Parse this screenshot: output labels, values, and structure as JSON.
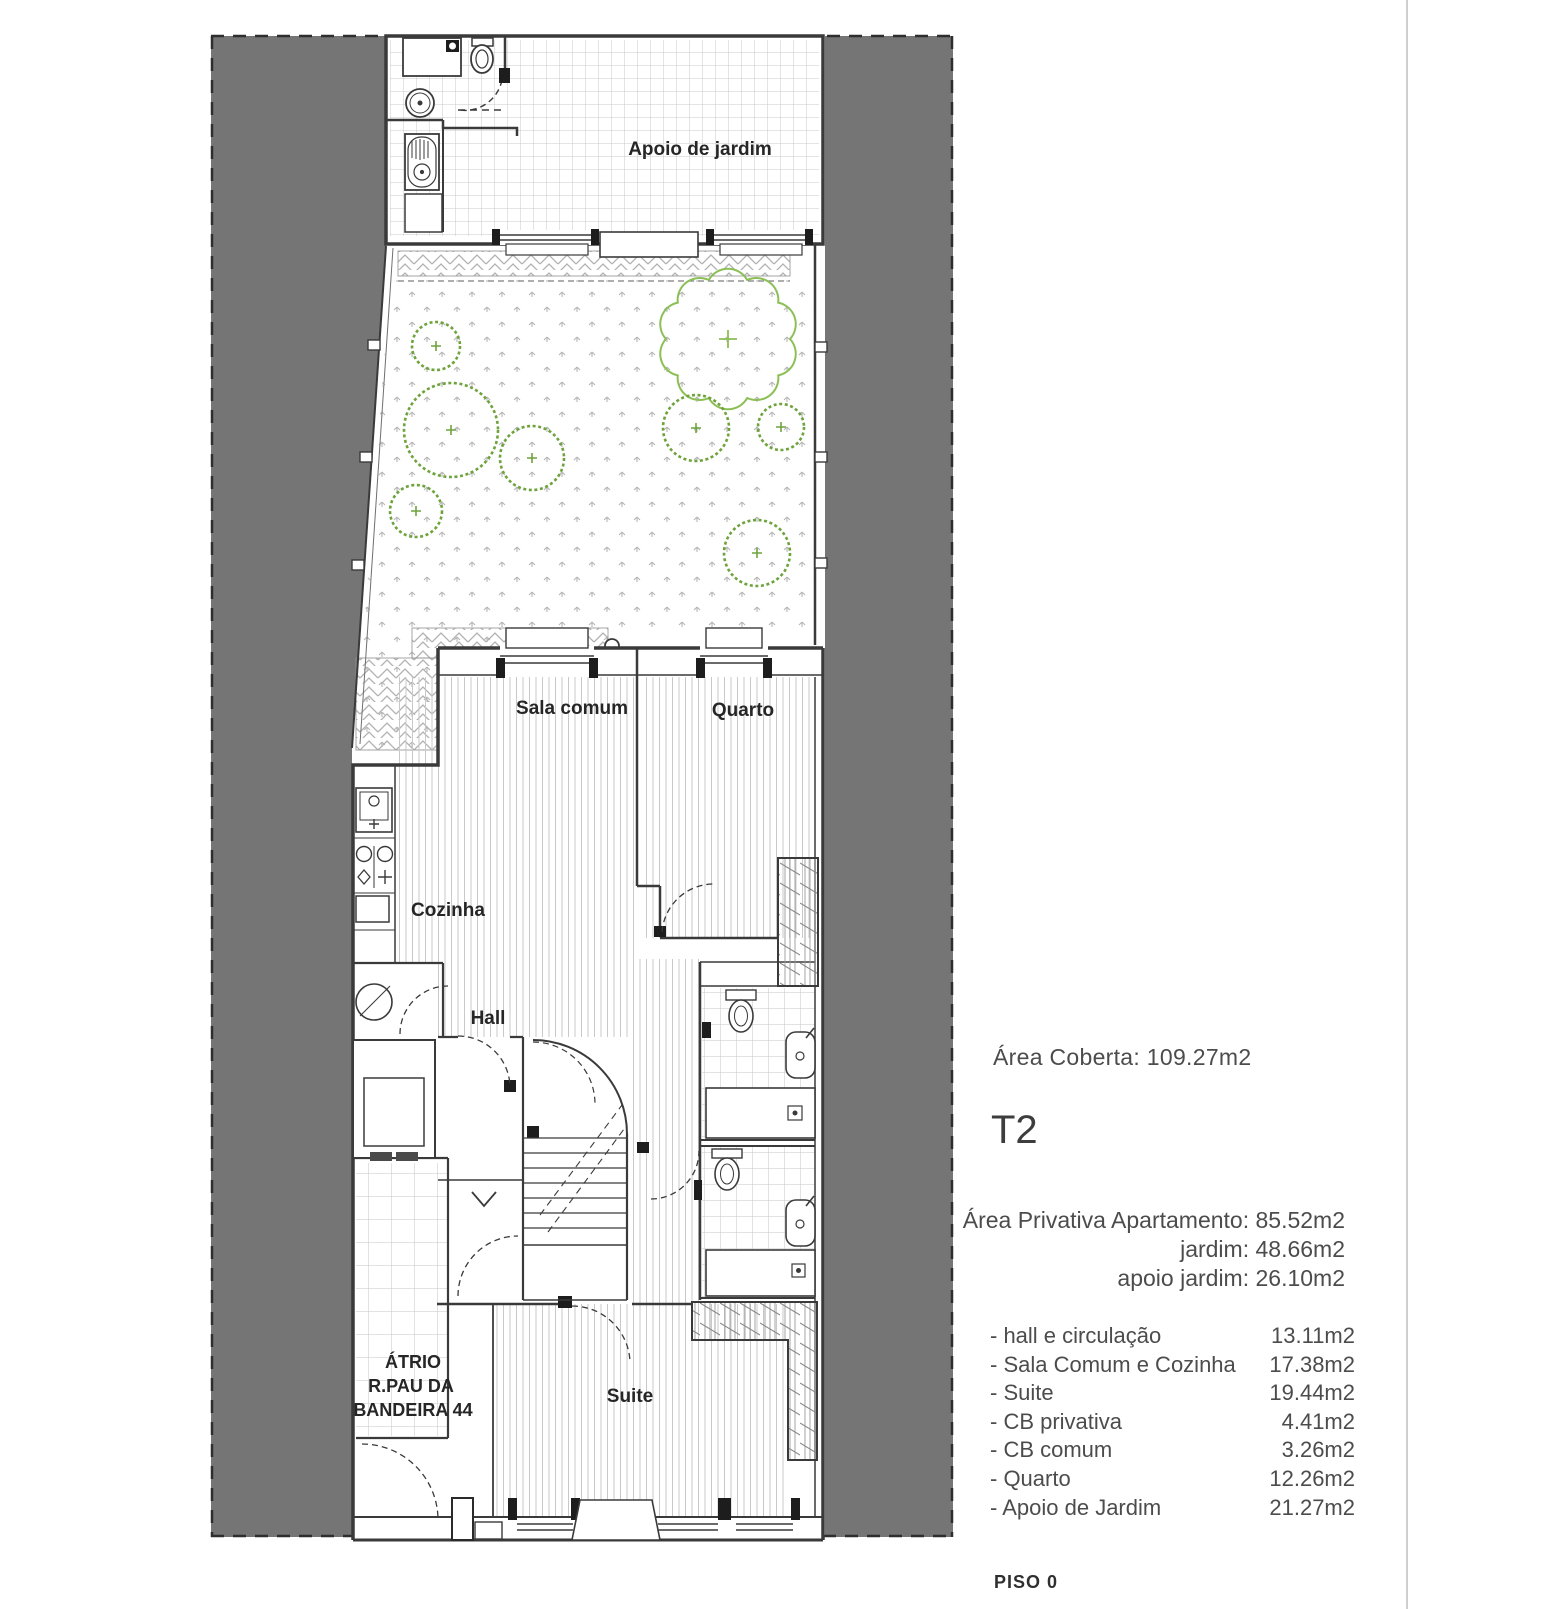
{
  "plan": {
    "labels": {
      "apoio": "Apoio de jardim",
      "sala": "Sala comum",
      "quarto": "Quarto",
      "cozinha": "Cozinha",
      "hall": "Hall",
      "suite": "Suite",
      "atrio1": "ÁTRIO",
      "atrio2": "R.PAU DA",
      "atrio3": "BANDEIRA 44"
    }
  },
  "panel": {
    "area_coberta": "Área Coberta: 109.27m2",
    "unit_type": "T2",
    "area_privativa": "Área Privativa Apartamento: 85.52m2",
    "area_jardim": "jardim: 48.66m2",
    "area_apoio_jardim": "apoio jardim:  26.10m2",
    "rooms": [
      {
        "label": "- hall e circulação",
        "area": "13.11m2"
      },
      {
        "label": "- Sala Comum e Cozinha",
        "area": "17.38m2"
      },
      {
        "label": "- Suite",
        "area": "19.44m2"
      },
      {
        "label": "- CB privativa",
        "area": "4.41m2"
      },
      {
        "label": "- CB comum",
        "area": "3.26m2"
      },
      {
        "label": "- Quarto",
        "area": "12.26m2"
      },
      {
        "label": "- Apoio de Jardim",
        "area": "21.27m2"
      }
    ],
    "floor_label": "PISO 0"
  },
  "colors": {
    "site_gray": "#757575",
    "wall": "#3a3a3a",
    "bush_green": "#6ea33c",
    "tree_green": "#8cbf56"
  }
}
